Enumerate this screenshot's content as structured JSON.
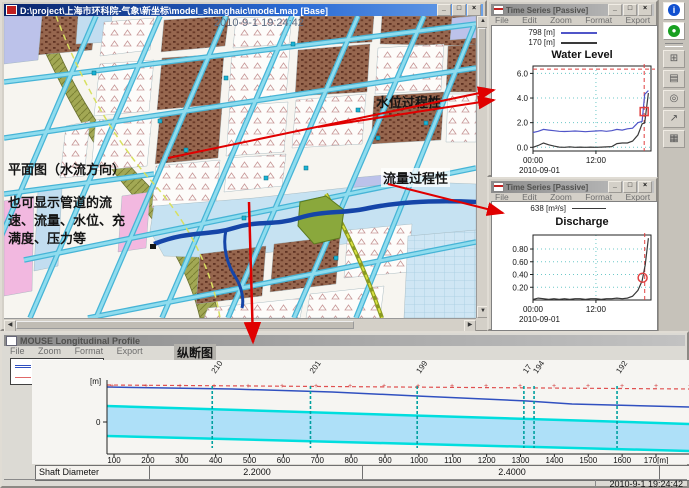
{
  "map_window": {
    "title": "D:\\project\\上海市环科院-气象\\新坐标\\model_shanghaic\\modeLmap [Base]",
    "overlay_datetime": "2010-9-1 19:24:42",
    "annotations": {
      "plan_view": "平面图（水流方向）",
      "pipe_info_line1": "也可显示管道的流",
      "pipe_info_line2": "速、流量、水位、充",
      "pipe_info_line3": "满度、压力等",
      "water_level_process": "水位过程性",
      "discharge_process": "流量过程性"
    }
  },
  "common": {
    "minimize": "_",
    "maximize": "□",
    "close": "×"
  },
  "ts1": {
    "title": "Time Series [Passive]",
    "menu": [
      "File",
      "Edit",
      "Zoom",
      "Format",
      "Export",
      "Window"
    ]
  },
  "ts2": {
    "title": "Time Series [Passive]",
    "menu": [
      "File",
      "Edit",
      "Zoom",
      "Format",
      "Export",
      "Window"
    ]
  },
  "profile_window": {
    "title": "MOUSE Longitudinal Profile",
    "menu": [
      "File",
      "Zoom",
      "Format",
      "Export"
    ],
    "section_label": "纵断图",
    "status_datetime": "2010-9-1 19:24:42"
  },
  "toolbar": {
    "icons": [
      "info-icon",
      "status-ok-icon",
      "window-icon",
      "document-icon",
      "globe-icon",
      "trend-icon",
      "grid-icon"
    ]
  },
  "colors": {
    "accent_arrow": "#e00000",
    "series_blue": "#5055c8",
    "series_black": "#3a3a3a",
    "marker_red": "#e04040",
    "pipe_cyan": "#00dede",
    "water_fill": "#aee0f8"
  },
  "chart_data": [
    {
      "id": "water_level",
      "type": "line",
      "title": "Water Level",
      "legend": [
        {
          "label": "798 [m]",
          "color": "#5055c8"
        },
        {
          "label": "170 [m]",
          "color": "#3a3a3a"
        }
      ],
      "x_date": "2010-09-01",
      "xticks": [
        {
          "h": 0,
          "label": "00:00"
        },
        {
          "h": 12,
          "label": "12:00"
        }
      ],
      "xlim": [
        0,
        22.5
      ],
      "ylim": [
        -0.3,
        6.6
      ],
      "yticks": [
        {
          "v": 0,
          "label": "0.0"
        },
        {
          "v": 2,
          "label": "2.0"
        },
        {
          "v": 4,
          "label": "4.0"
        },
        {
          "v": 6,
          "label": "6.0"
        }
      ],
      "hline": 6.35,
      "vline": 21.2,
      "marker": {
        "h": 21.2,
        "v": 2.9,
        "shape": "square",
        "color": "#e04040"
      },
      "series": [
        {
          "name": "798 [m]",
          "color": "#5055c8",
          "points": [
            [
              0,
              1.2
            ],
            [
              1,
              1.3
            ],
            [
              2,
              1.45
            ],
            [
              3,
              1.4
            ],
            [
              4,
              1.35
            ],
            [
              5,
              1.3
            ],
            [
              6,
              1.28
            ],
            [
              7,
              1.3
            ],
            [
              8,
              1.32
            ],
            [
              9,
              1.3
            ],
            [
              10,
              1.27
            ],
            [
              11,
              1.3
            ],
            [
              12,
              1.32
            ],
            [
              13,
              1.35
            ],
            [
              14,
              1.3
            ],
            [
              15,
              1.35
            ],
            [
              16,
              1.45
            ],
            [
              17,
              1.4
            ],
            [
              18,
              1.5
            ],
            [
              19,
              1.55
            ],
            [
              20,
              2.0
            ],
            [
              20.8,
              2.1
            ],
            [
              21.3,
              4.3
            ],
            [
              22,
              4.6
            ]
          ]
        },
        {
          "name": "170 [m]",
          "color": "#3a3a3a",
          "points": [
            [
              0,
              0.0
            ],
            [
              1,
              0.15
            ],
            [
              2,
              0.35
            ],
            [
              3,
              0.2
            ],
            [
              4,
              0.1
            ],
            [
              5,
              0.02
            ],
            [
              6,
              0.0
            ],
            [
              7,
              0.03
            ],
            [
              8,
              0.0
            ],
            [
              9,
              0.02
            ],
            [
              10,
              0.0
            ],
            [
              11,
              0.02
            ],
            [
              12,
              0.0
            ],
            [
              13,
              0.02
            ],
            [
              14,
              0.03
            ],
            [
              15,
              0.06
            ],
            [
              16,
              0.3
            ],
            [
              17,
              0.35
            ],
            [
              18,
              0.35
            ],
            [
              19,
              0.5
            ],
            [
              20,
              1.0
            ],
            [
              20.8,
              1.9
            ],
            [
              21.3,
              2.0
            ],
            [
              22,
              4.4
            ]
          ]
        }
      ]
    },
    {
      "id": "discharge",
      "type": "line",
      "title": "Discharge",
      "legend": [
        {
          "label": "638 [m³/s]",
          "color": "#3a3a3a"
        }
      ],
      "x_date": "2010-09-01",
      "xticks": [
        {
          "h": 0,
          "label": "00:00"
        },
        {
          "h": 12,
          "label": "12:00"
        }
      ],
      "xlim": [
        0,
        22.5
      ],
      "ylim": [
        0,
        1.02
      ],
      "yticks": [
        {
          "v": 0.2,
          "label": "0.20"
        },
        {
          "v": 0.4,
          "label": "0.40"
        },
        {
          "v": 0.6,
          "label": "0.60"
        },
        {
          "v": 0.8,
          "label": "0.80"
        }
      ],
      "vline": 21.3,
      "marker": {
        "h": 20.9,
        "v": 0.35,
        "shape": "circle",
        "color": "#e04040"
      },
      "series": [
        {
          "name": "638 [m³/s]",
          "color": "#3a3a3a",
          "points": [
            [
              0,
              0.01
            ],
            [
              1,
              0.03
            ],
            [
              2,
              0.02
            ],
            [
              3,
              0.01
            ],
            [
              4,
              0.02
            ],
            [
              5,
              0.01
            ],
            [
              6,
              0.02
            ],
            [
              7,
              0.01
            ],
            [
              8,
              0.02
            ],
            [
              9,
              0.02
            ],
            [
              10,
              0.01
            ],
            [
              11,
              0.02
            ],
            [
              12,
              0.02
            ],
            [
              13,
              0.01
            ],
            [
              14,
              0.02
            ],
            [
              15,
              0.02
            ],
            [
              16,
              0.03
            ],
            [
              17,
              0.02
            ],
            [
              18,
              0.03
            ],
            [
              19,
              0.06
            ],
            [
              20,
              0.15
            ],
            [
              20.8,
              0.3
            ],
            [
              21.4,
              0.55
            ],
            [
              22,
              0.97
            ]
          ]
        }
      ]
    },
    {
      "id": "longitudinal_profile",
      "type": "profile",
      "title": "MOUSE Longitudinal Profile",
      "legend": [
        {
          "label": "Link Water Level",
          "color": "#3050c0"
        },
        {
          "label": "Link Water Level",
          "color": "#e06868"
        }
      ],
      "y_unit": "[m]",
      "y_zero_label": "0",
      "nodes": [
        {
          "label": "210",
          "chainage": 390
        },
        {
          "label": "201",
          "chainage": 680
        },
        {
          "label": "199",
          "chainage": 995
        },
        {
          "label": "17",
          "chainage": 1310
        },
        {
          "label": "194",
          "chainage": 1340
        },
        {
          "label": "192",
          "chainage": 1585
        }
      ],
      "xtick_values": [
        100,
        200,
        300,
        400,
        500,
        600,
        700,
        800,
        900,
        1000,
        1100,
        1200,
        1300,
        1400,
        1500,
        1600,
        1700
      ],
      "xtick_labels": [
        "100",
        "200",
        "300",
        "400",
        "500",
        "600",
        "700",
        "800",
        "900",
        "1000",
        "1100",
        "1200",
        "1300",
        "1400",
        "1500",
        "1600",
        "170[m]"
      ],
      "shaft_diameter": {
        "label": "Shaft Diameter",
        "segments": [
          "2.2000",
          "2.4000"
        ]
      }
    }
  ]
}
